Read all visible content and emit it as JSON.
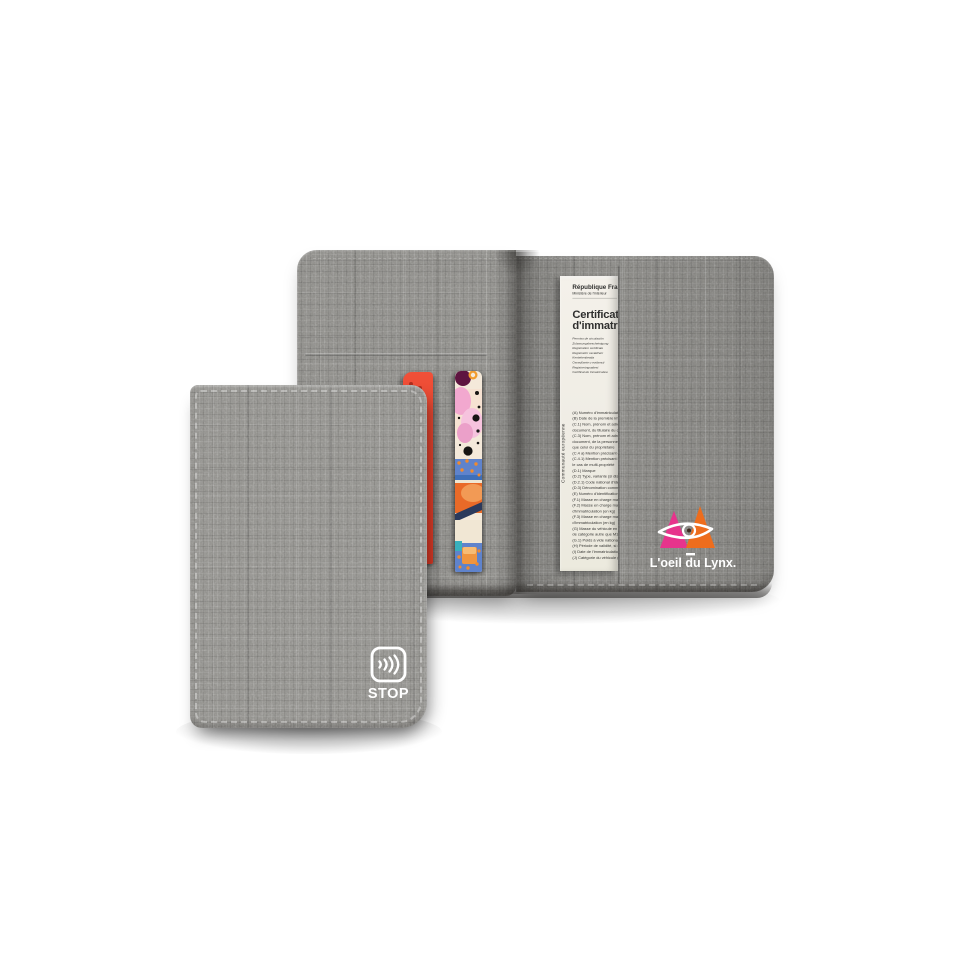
{
  "canvas": {
    "background": "#ffffff"
  },
  "closed_wallet": {
    "fabric_color": "#92918d",
    "rfid_blocker": {
      "label": "STOP",
      "icon": "contactless-waves-icon",
      "color": "#ffffff"
    }
  },
  "open_wallet": {
    "fabric_color": "#898884",
    "brand": {
      "wordmark": "L'oeil du Lynx.",
      "pink": "#e7338c",
      "orange": "#ee6d1d",
      "eye_color": "#ffffff"
    },
    "cards": {
      "red_card_color": "#e8432e",
      "art_card_palette": [
        "#f4e9da",
        "#f2a8cf",
        "#5e1440",
        "#5f83cc",
        "#e96a28",
        "#2c3a5c",
        "#f0953f"
      ]
    },
    "document": {
      "paper_color": "#f2efe8",
      "side_label": "Communauté européenne",
      "authority": "République Française",
      "ministry": "Ministère de l'intérieur",
      "title_line1": "Certificat",
      "title_line2": "d'immatriculation",
      "translations": [
        "Permiso de circulación",
        "Zulassungsbescheinigung",
        "Registration certificate",
        "Registrační osvědčení",
        "Kentekenbewijs",
        "Osvedčenie o evidencii",
        "Registreringsattest",
        "Certificat de înmatriculare"
      ],
      "fields": [
        "(A) Numéro d'immatriculation",
        "(B) Date de la première immatriculation",
        "(C.1) Nom, prénom et adresse dans le",
        "document, du titulaire du certificat",
        "(C.3) Nom, prénom et adresse dans le",
        "document, de la personne physique",
        "que celui du propriétaire",
        "(C.4 a) Mention précisant que le titulaire",
        "(C.4.1) Mention précisant le cas échéant",
        "le cas de multi-propriété",
        "(D.1) Marque",
        "(D.2) Type, variante (si disponible),",
        "(D.2.1) Code national d'identification",
        "(D.3) Dénomination commerciale",
        "(E) Numéro d'identification du véhicule",
        "(F.1) Masse en charge maximale",
        "(F.2) Masse en charge maximale admise",
        "d'immatriculation (en kg)",
        "(F.3) Masse en charge maximale admise",
        "d'immatriculation (en kg)",
        "(G) Masse du véhicule en service avec",
        "de catégorie autre que M1",
        "(G.1) Poids à vide national",
        "(H) Période de validité, si elle est limitée",
        "(I) Date de l'immatriculation à laquelle",
        "(J) Catégorie du véhicule (CE)"
      ]
    }
  }
}
